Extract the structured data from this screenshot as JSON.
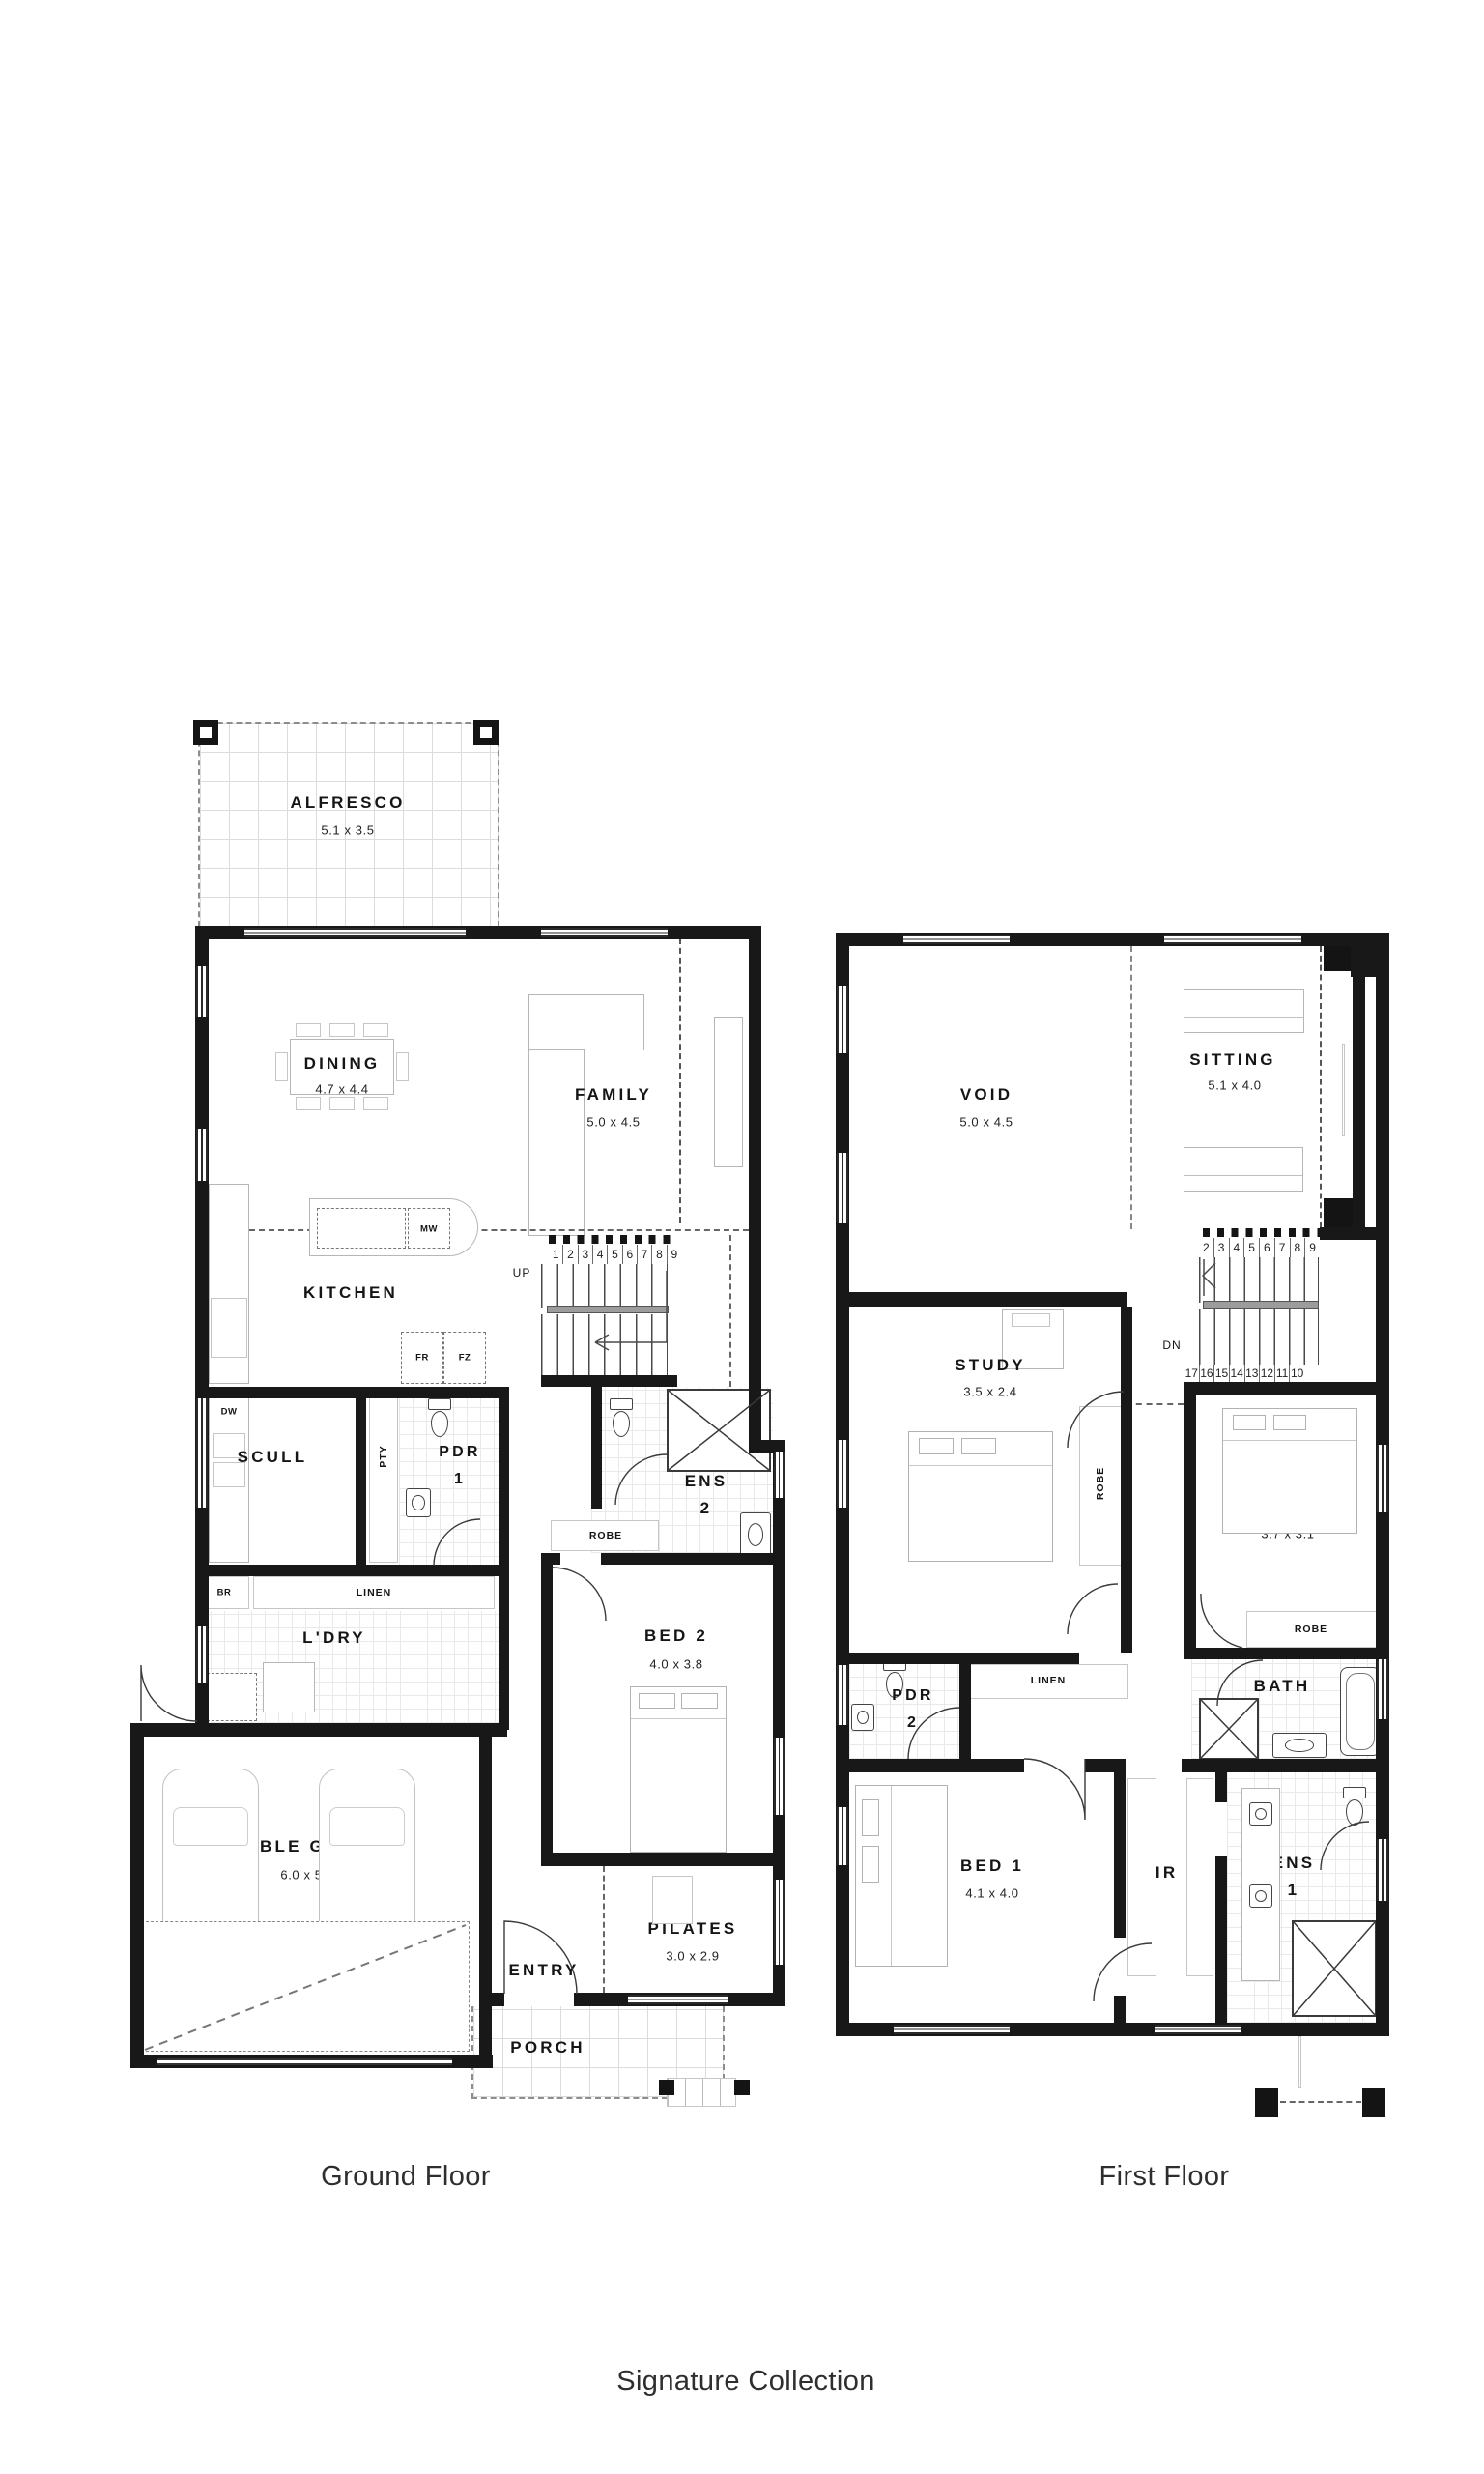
{
  "captions": {
    "ground": "Ground Floor",
    "first": "First Floor",
    "collection": "Signature Collection"
  },
  "colors": {
    "wall": "#181818",
    "furniture": "#b6b6b6",
    "tile": "#e9e9e9",
    "dash": "#666666",
    "text": "#151515"
  },
  "gf": {
    "alfresco": {
      "name": "ALFRESCO",
      "dim": "5.1 x 3.5"
    },
    "dining": {
      "name": "DINING",
      "dim": "4.7 x 4.4"
    },
    "family": {
      "name": "FAMILY",
      "dim": "5.0 x 4.5"
    },
    "kitchen": {
      "name": "KITCHEN"
    },
    "scull": {
      "name": "SCULL"
    },
    "ldry": {
      "name": "L'DRY"
    },
    "pdr1": {
      "line1": "PDR",
      "line2": "1"
    },
    "ens2": {
      "line1": "ENS",
      "line2": "2"
    },
    "bed2": {
      "name": "BED 2",
      "dim": "4.0 x 3.8"
    },
    "garage": {
      "name": "DOUBLE GARAGE",
      "dim": "6.0 x 5.9"
    },
    "entry": {
      "name": "ENTRY"
    },
    "pilates": {
      "name": "PILATES",
      "dim": "3.0 x 2.9"
    },
    "porch": {
      "name": "PORCH"
    },
    "mw": "MW",
    "fr": "FR",
    "fz": "FZ",
    "dw": "DW",
    "pty": "PTY",
    "br": "BR",
    "linen": "LINEN",
    "robe": "ROBE",
    "up": "UP",
    "stairs": [
      "1",
      "2",
      "3",
      "4",
      "5",
      "6",
      "7",
      "8",
      "9"
    ]
  },
  "ff": {
    "void": {
      "name": "VOID",
      "dim": "5.0 x 4.5"
    },
    "sitting": {
      "name": "SITTING",
      "dim": "5.1 x 4.0"
    },
    "study": {
      "name": "STUDY",
      "dim": "3.5 x 2.4"
    },
    "bed3": {
      "name": "BED 3",
      "dim": "3.7 x 3.6"
    },
    "bed4": {
      "name": "BED 4",
      "dim": "3.7 x 3.1"
    },
    "bed1": {
      "name": "BED 1",
      "dim": "4.1 x 4.0"
    },
    "bath": {
      "name": "BATH"
    },
    "wir": {
      "name": "WIR"
    },
    "pdr2": {
      "line1": "PDR",
      "line2": "2"
    },
    "ens1": {
      "line1": "ENS",
      "line2": "1"
    },
    "robe3": "ROBE",
    "robe4": "ROBE",
    "linen": "LINEN",
    "dn": "DN",
    "stairs_top": [
      "2",
      "3",
      "4",
      "5",
      "6",
      "7",
      "8",
      "9"
    ],
    "stairs_bottom": [
      "17",
      "16",
      "15",
      "14",
      "13",
      "12",
      "11",
      "10"
    ]
  }
}
